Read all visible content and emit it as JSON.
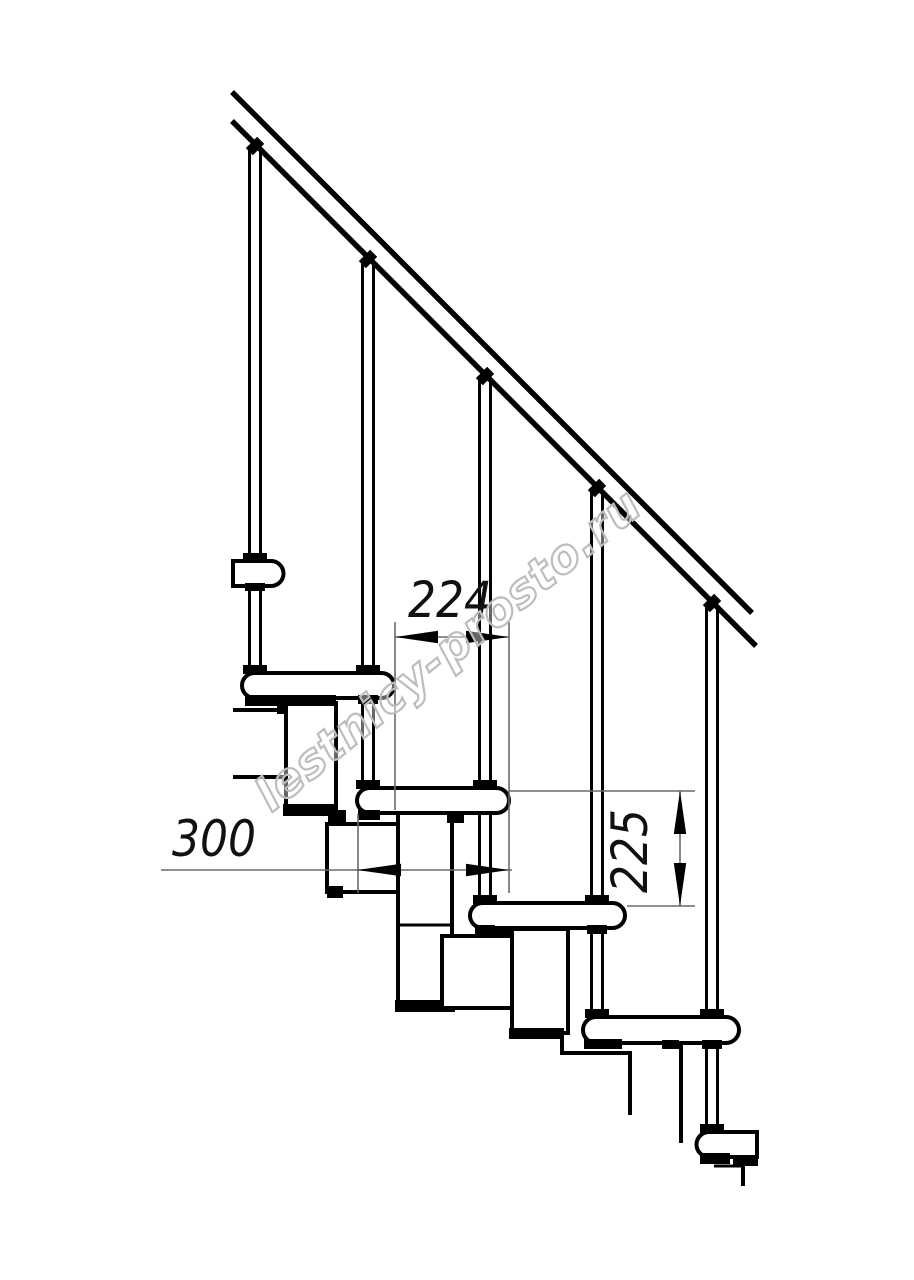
{
  "page": {
    "width": 914,
    "height": 1280,
    "background": "#ffffff"
  },
  "drawing": {
    "subject": "modular-staircase-side-elevation",
    "treads_visible": 6,
    "balusters_visible": 5,
    "line_color": "#000000",
    "dimension_line_color": "#6a6a6a"
  },
  "annotations": {
    "step_run": "224",
    "tread_depth": "300",
    "riser_height": "225"
  },
  "watermark": {
    "text": "lestnicy-prosto.ru",
    "color": "#bdbdbd"
  }
}
